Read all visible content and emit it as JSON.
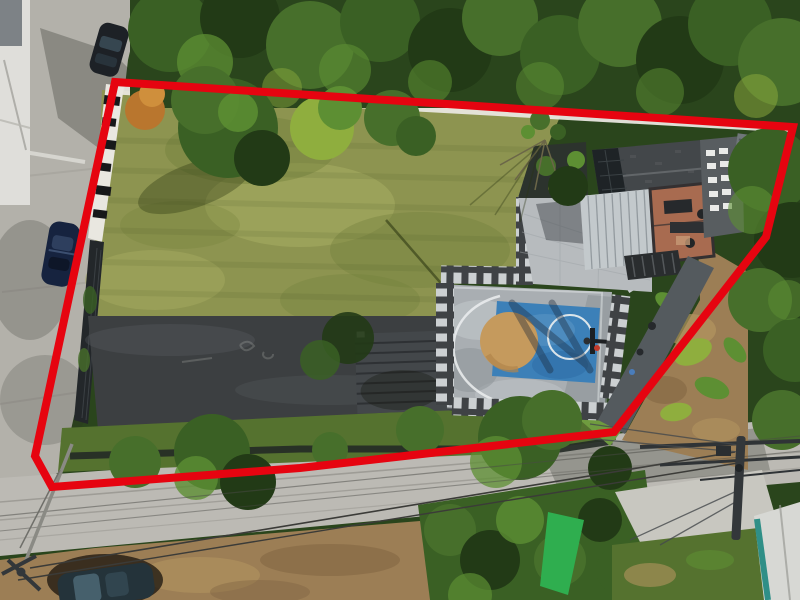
{
  "meta": {
    "type": "aerial-drone-photo",
    "description": "Top-down drone photograph of a residential land plot outlined with a thick red property-boundary overlay; plot contains a large lawn, a house with dark shingle and grey metal roofs, a wooden deck, a blue half basketball court with tan centre circle, checkered walkway strips, an asphalt parking pad, bordered by two concrete roads, parked cars, utility poles with power lines and dense tree canopy."
  },
  "annotation": {
    "label": "property-boundary",
    "boundary_points": "115,82 793,127 766,237 614,432 300,468 52,487 35,456",
    "color": "#e60410",
    "stroke_width": 8
  },
  "palette": {
    "treeBase": "#2a451c",
    "treeDark": "#223a16",
    "treeMid": "#3a6024",
    "treeMid2": "#476f2b",
    "treeLight": "#5d8f33",
    "treeYellow": "#8fae3e",
    "treeOrange": "#b9762e",
    "treeOrange2": "#cf8f3c",
    "lawn": "#8d9450",
    "lawnLight": "#a8ad62",
    "lawnDark": "#73803c",
    "grassStrip": "#55722f",
    "hedge": "#6f9b3f",
    "roadLeft": "#b3b1aa",
    "roadBottom": "#bcbab4",
    "roadSeam": "#97958f",
    "concretePale": "#c8c7c0",
    "asphalt": "#3c3f41",
    "asphaltLight": "#595d60",
    "courtGray": "#a9aeb2",
    "courtGrayLight": "#c2c6c9",
    "courtGrayDark": "#8b9196",
    "courtBlue": "#3c80b8",
    "courtBlueDark": "#2f6ea6",
    "courtBlueLight": "#5e97c6",
    "courtTan": "#c59a5d",
    "courtTanDark": "#b0854b",
    "ladderDark": "#3f4245",
    "ladderLight": "#ccd0d2",
    "patio": "#b7bbbe",
    "patioJoint": "#9fa4a8",
    "shingle": "#43474a",
    "shingleLight": "#5b5f63",
    "panel": "#1e2326",
    "metalRoof": "#c3c9cc",
    "metalRib": "#8e969b",
    "deck": "#a86b50",
    "deckDark": "#343031",
    "furniture": "#26292c",
    "dirt": "#9c7e55",
    "dirtLight": "#b3955f",
    "dirtDark": "#7e6240",
    "wallWhite": "#e9e7e0",
    "fenceDark": "#23272a",
    "wallShadow": "#242a26",
    "carBlack": "#1d2126",
    "carNavy": "#16233f",
    "carTeal": "#24333a",
    "glass": "#46606c",
    "driveway": "#545a5e",
    "stone": "#e9eae8",
    "pergola": "#70767a",
    "tarp": "#2fae4f",
    "teal": "#2f8f87",
    "buildingWhite": "#d7d8d4",
    "white": "#f2f2ee",
    "red": "#e60410",
    "ball": "#c23a2a",
    "poleDark": "#33373a",
    "cable": "#3b3b38"
  },
  "scene": {
    "objects": [
      "red property boundary overlay",
      "front lawn",
      "basketball half-court",
      "tan centre circle",
      "basketball hoop",
      "house shingle roof",
      "grey metal roof",
      "wooden deck with furniture",
      "deck stairs",
      "checkered walkway strips",
      "paver patio",
      "asphalt parking pad",
      "shed roof",
      "white boundary wall",
      "dark slat fence",
      "left access road",
      "bottom concrete road",
      "parked black car",
      "parked navy car",
      "parked dark SUV",
      "utility pole with crossarms",
      "power lines",
      "green tarp",
      "tropical plants",
      "tree canopy",
      "white building corner with teal edge",
      "stepping stones",
      "pergola seating set"
    ]
  }
}
